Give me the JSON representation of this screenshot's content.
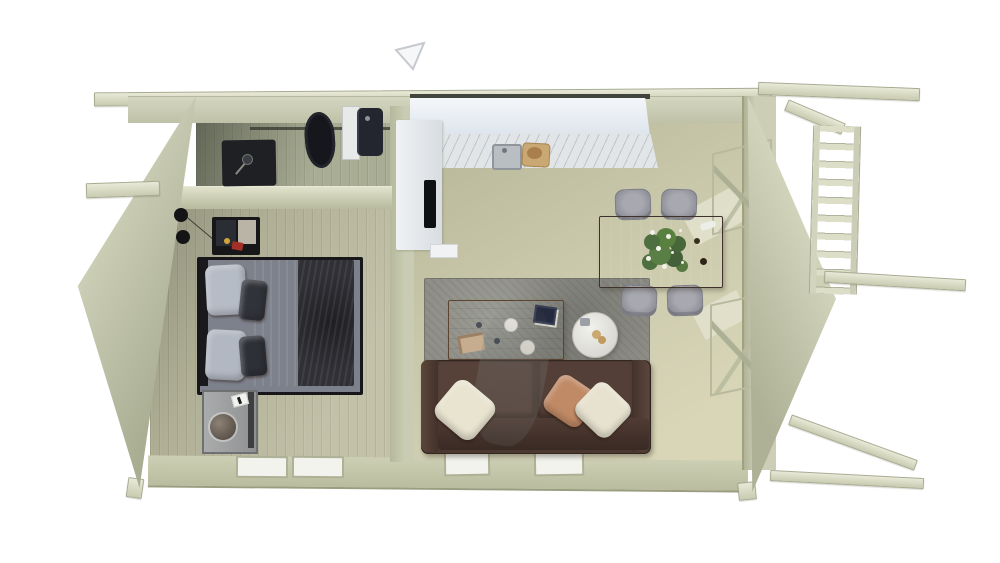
{
  "scene": {
    "kind": "3d-top-down-cutaway-floor-plan-render",
    "subject": "two-room log cabin with side porch, viewed from above",
    "background_color": "#ffffff"
  },
  "palette": {
    "wall_wood": "#c9ccb3",
    "wall_shadow": "#a9ad92",
    "floor_wood": "#c6c5a8",
    "beam_wood": "#d8dac4",
    "kitchen_white": "#eef1f4",
    "marble_counter": "#e2e5e7",
    "cooktop_black": "#0e1013",
    "dining_table_brown": "#5c463a",
    "chair_gray": "#97979f",
    "rug_stone_gray": "#8f8f88",
    "coffee_table_wood": "#8d6a4a",
    "sofa_leather_brown": "#4a3831",
    "pillow_cream": "#e9e4d0",
    "pillow_tan": "#c08a66",
    "bed_duvet_dark": "#303036",
    "bed_pillow_gray": "#b6bcc6",
    "fixture_black": "#15171c",
    "flower_green": "#4e7040",
    "flower_white": "#f1f1e8",
    "glass_green": "#dfe3d8"
  },
  "rooms": {
    "bathroom": {
      "position": "top-left",
      "objects": [
        "toilet",
        "washbasin-vanity",
        "dark-bath-mat",
        "glass-shelf",
        "small-lamp"
      ]
    },
    "bedroom": {
      "position": "left",
      "objects": [
        "double-bed-dark-bedding",
        "gray-pillows",
        "wall-lamp-two-heads",
        "wall-desk-with-red-item",
        "bedside-cabinet",
        "round-table-lamp",
        "window",
        "window"
      ]
    },
    "living_kitchen": {
      "position": "right",
      "objects": [
        "l-shaped-white-kitchen-counter",
        "marble-worktop",
        "sink",
        "cutting-board-with-bread",
        "black-cooktop",
        "dining-table",
        "chair",
        "chair",
        "chair",
        "chair",
        "flower-centerpiece",
        "stone-gray-rug",
        "wood-coffee-table",
        "book",
        "cups-and-plates",
        "round-side-table",
        "brown-leather-sofa",
        "cream-pillow",
        "tan-pillow",
        "cream-pillow",
        "window",
        "window",
        "glazed-door",
        "glazed-door"
      ]
    },
    "porch": {
      "position": "right-exterior",
      "objects": [
        "top-beam",
        "slatted-railing",
        "middle-beam",
        "diagonal-brace-beam",
        "bottom-beam"
      ]
    }
  },
  "marker": {
    "type": "faint-gray-triangle-arrow",
    "position": "top-center"
  }
}
